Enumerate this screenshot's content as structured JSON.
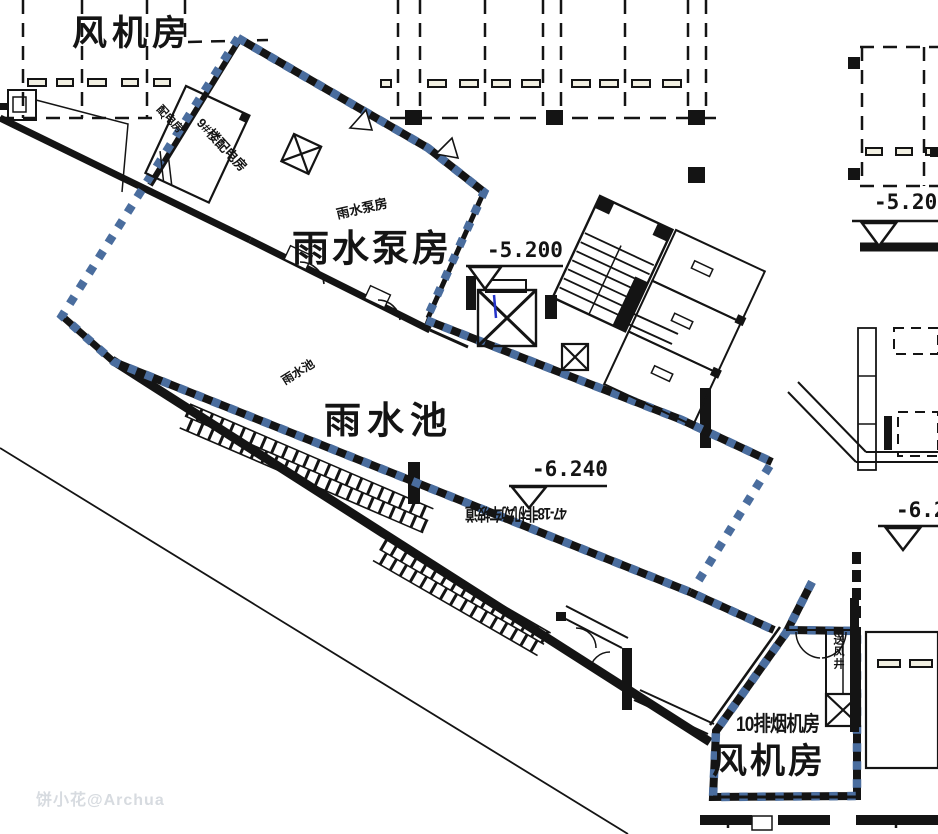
{
  "drawing": {
    "type": "basement-floor-plan",
    "rooms": {
      "fan_room_top": "风机房",
      "fan_room_bottom": "风机房",
      "rain_pump_room": "雨水泵房",
      "rain_pump_room_small": "雨水泵房",
      "rain_pool": "雨水池",
      "rain_pool_small": "雨水池",
      "distribution_room_9": "9#楼配电房",
      "distribution_room_small": "配电房",
      "smoke_exhaust_room_10": "10排烟机房",
      "air_supply_shaft": "送风井",
      "bicycle_ramp": "47-18非机动车坡道"
    },
    "elevations": {
      "pump_room_level": "-5.200",
      "pool_level": "-6.240",
      "right_top_level": "-5.20",
      "right_mid_level": "-6.2"
    },
    "colors": {
      "fire_boundary_blue": "#4a6d9e",
      "line_black": "#141414",
      "accent_blue_line": "#2433c9",
      "wheel_stop_fill": "#f2f0e2",
      "watermark_gray": "#b8bfc9"
    },
    "watermark": "饼小花@Archua"
  }
}
